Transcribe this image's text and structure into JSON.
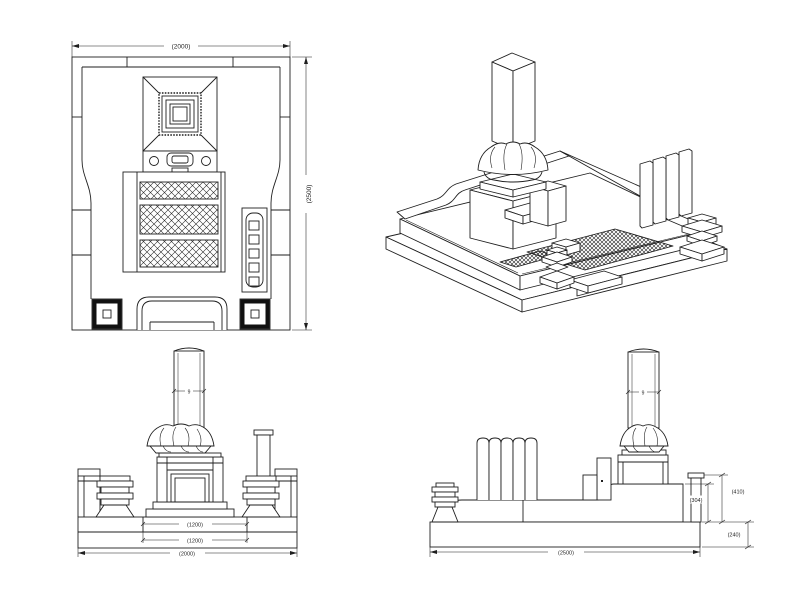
{
  "drawing": {
    "background_color": "#ffffff",
    "line_color": "#1f1f1f",
    "plan_view": {
      "dim_width": "(2000)",
      "dim_depth": "(2500)"
    },
    "front_view": {
      "dim_pillar": "9",
      "dim_step_upper": "(1200)",
      "dim_step_lower": "(1200)",
      "dim_total": "(2000)"
    },
    "side_view": {
      "dim_pillar": "9",
      "dim_height_upper": "(304)",
      "dim_height_total": "(410)",
      "dim_height_base": "(240)",
      "dim_total": "(2500)"
    }
  }
}
